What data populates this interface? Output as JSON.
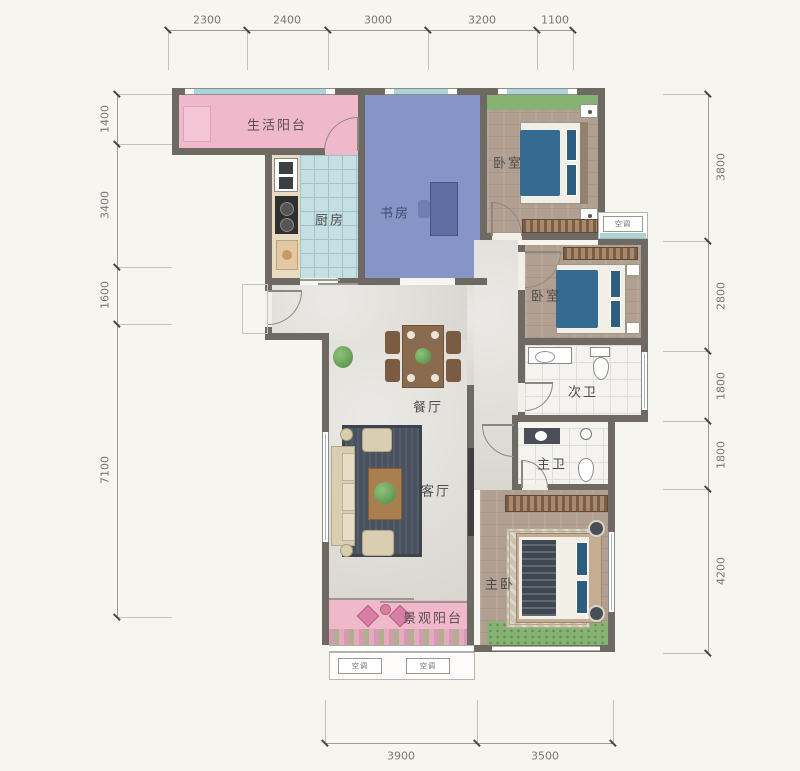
{
  "plan_type": "apartment-floor-plan",
  "rooms": {
    "service_balcony": "生活阳台",
    "kitchen": "厨房",
    "study": "书房",
    "bedroom1": "卧室",
    "bedroom2": "卧室",
    "bath_secondary": "次卫",
    "bath_master": "主卫",
    "dining": "餐厅",
    "living": "客厅",
    "master_bedroom": "主卧",
    "view_balcony": "景观阳台"
  },
  "ac": {
    "label": "空调"
  },
  "dims": {
    "top": [
      "2300",
      "2400",
      "3000",
      "3200",
      "1100"
    ],
    "left": [
      "1400",
      "3400",
      "1600",
      "7100"
    ],
    "right": [
      "3800",
      "2800",
      "1800",
      "1800",
      "4200"
    ],
    "bottom": [
      "3900",
      "3500"
    ]
  },
  "colors": {
    "wall": "#6e6a63",
    "balcony_pink": "#f0b9cb",
    "study_blue": "#8595c5",
    "kitchen_tile": "#c5dfe2",
    "wood_floor": "#b19f91",
    "marble_floor": "#e0ddd7",
    "window_teal": "#aad4da",
    "greenery": "#86b273",
    "bed_blue": "#356a91",
    "background": "#f7f5f0"
  }
}
